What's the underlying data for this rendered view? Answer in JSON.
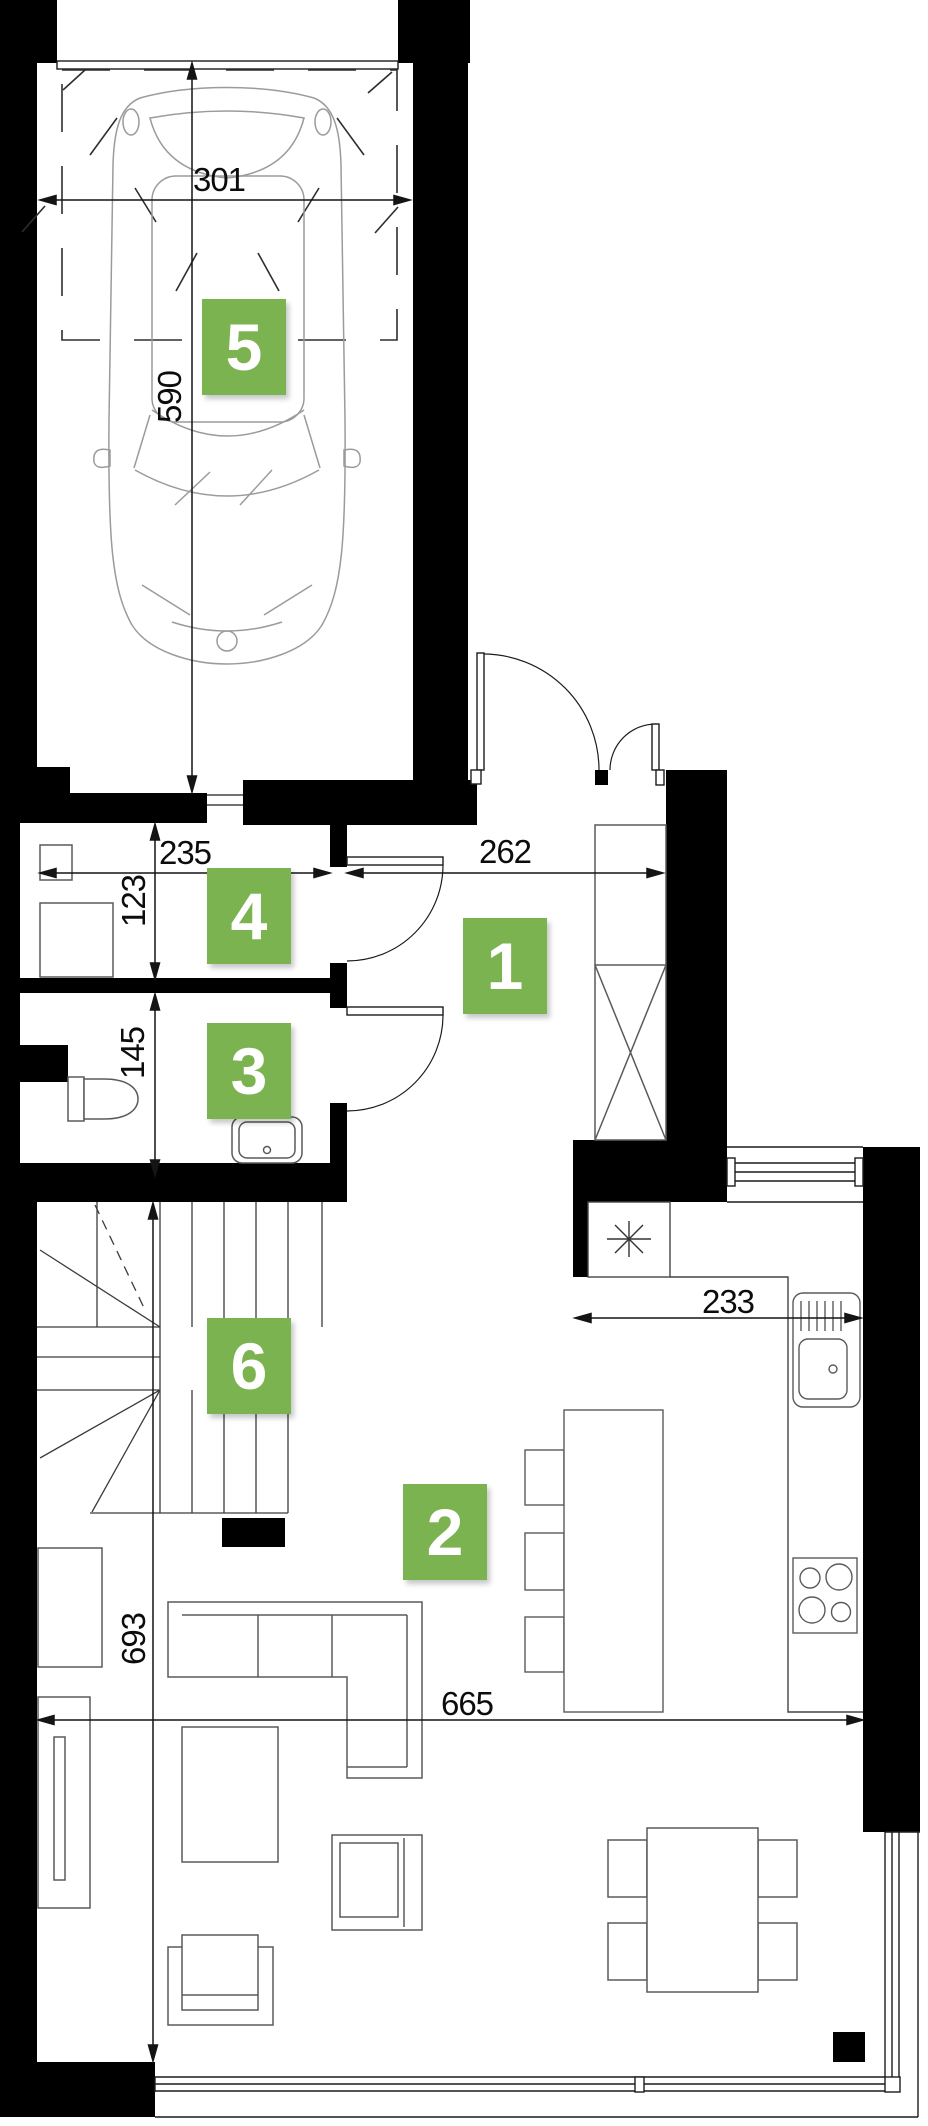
{
  "labels": {
    "room1": "1",
    "room2": "2",
    "room3": "3",
    "room4": "4",
    "room5": "5",
    "room6": "6"
  },
  "dimensions": {
    "garage_width": "301",
    "garage_depth": "590",
    "utility_width": "235",
    "utility_depth": "123",
    "wc_depth": "145",
    "hall_width": "262",
    "kitchen_width": "233",
    "living_depth": "693",
    "living_width": "665"
  },
  "colors": {
    "label_green": "#7CB351",
    "wall_black": "#000000",
    "furniture_line": "#5a5a5a",
    "car_line": "#9b9b9b",
    "dimension_line": "#141414"
  }
}
